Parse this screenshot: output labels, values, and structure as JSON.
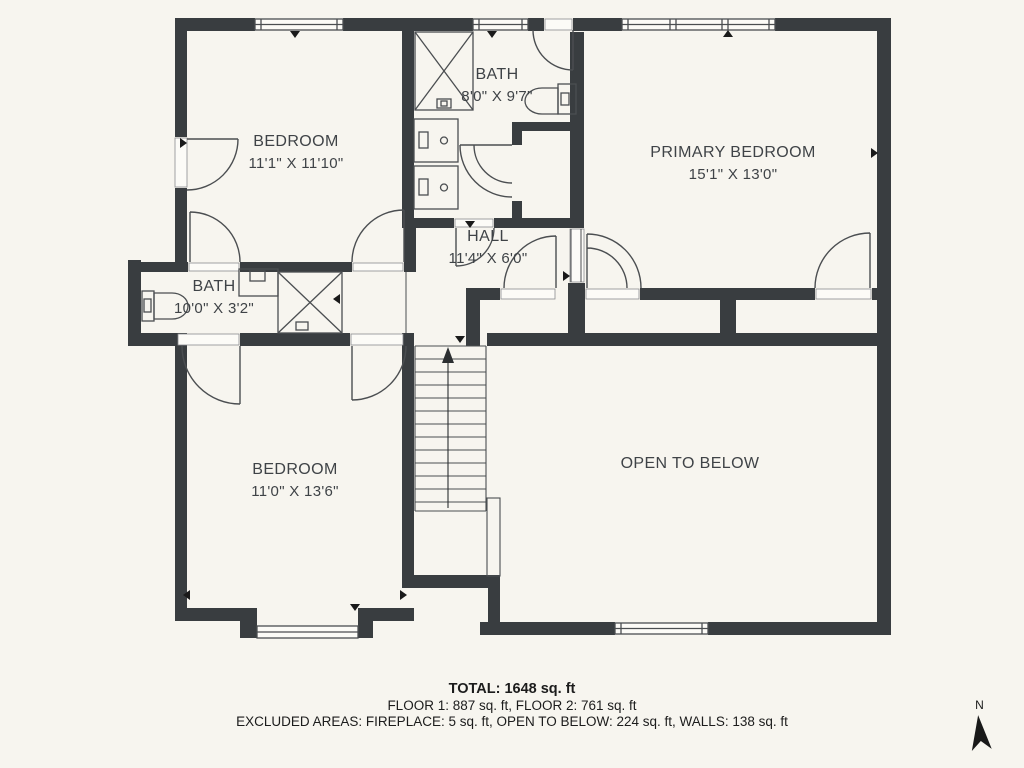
{
  "rooms": [
    {
      "id": "bedroom-top-left",
      "name": "BEDROOM",
      "dims": "11'1\" X 11'10\""
    },
    {
      "id": "bath-top",
      "name": "BATH",
      "dims": "8'0\" X 9'7\""
    },
    {
      "id": "primary-bedroom",
      "name": "PRIMARY BEDROOM",
      "dims": "15'1\" X 13'0\""
    },
    {
      "id": "hall",
      "name": "HALL",
      "dims": "11'4\" X 6'0\""
    },
    {
      "id": "bath-left",
      "name": "BATH",
      "dims": "10'0\" X 3'2\""
    },
    {
      "id": "bedroom-bottom-left",
      "name": "BEDROOM",
      "dims": "11'0\" X 13'6\""
    },
    {
      "id": "open-to-below",
      "name": "OPEN TO BELOW",
      "dims": ""
    }
  ],
  "summary": {
    "total": "TOTAL: 1648 sq. ft",
    "floors": "FLOOR 1: 887 sq. ft, FLOOR 2: 761 sq. ft",
    "excluded": "EXCLUDED AREAS: FIREPLACE: 5 sq. ft, OPEN TO BELOW: 224 sq. ft, WALLS: 138 sq. ft"
  },
  "compass": {
    "label": "N"
  },
  "colors": {
    "background": "#f7f5ef",
    "wall": "#393d40",
    "line": "#4b4e51",
    "text": "#3f4347"
  }
}
